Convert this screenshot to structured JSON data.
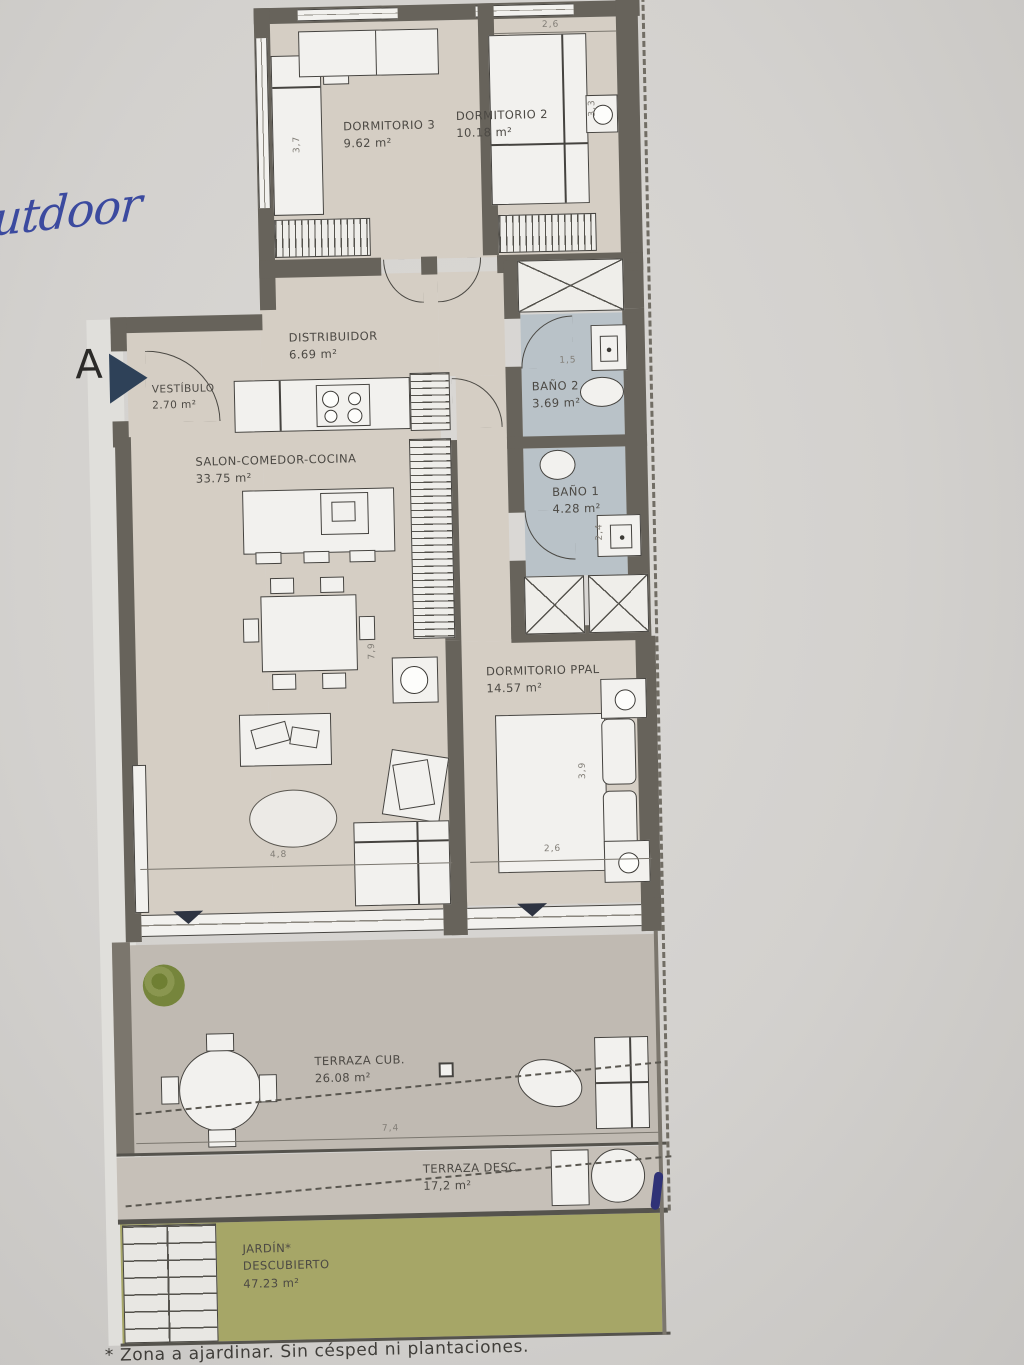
{
  "annotations": {
    "handwritten_note": "outdoor",
    "section_marker": "A",
    "footnote": "* Zona a ajardinar. Sin césped ni plantaciones."
  },
  "rooms": [
    {
      "name": "DORMITORIO 3",
      "area": "9.62 m²"
    },
    {
      "name": "DORMITORIO 2",
      "area": "10.18 m²"
    },
    {
      "name": "DISTRIBUIDOR",
      "area": "6.69 m²"
    },
    {
      "name": "VESTÍBULO",
      "area": "2.70 m²"
    },
    {
      "name": "BAÑO 2",
      "area": "3.69 m²"
    },
    {
      "name": "SALON-COMEDOR-COCINA",
      "area": "33.75 m²"
    },
    {
      "name": "BAÑO 1",
      "area": "4.28 m²"
    },
    {
      "name": "DORMITORIO PPAL",
      "area": "14.57 m²"
    },
    {
      "name": "TERRAZA CUB.",
      "area": "26.08 m²"
    },
    {
      "name": "TERRAZA DESC.",
      "area": "17,2 m²"
    },
    {
      "name": "JARDÍN*",
      "name2": "DESCUBIERTO",
      "area": "47.23 m²"
    }
  ],
  "dims": {
    "dorm2_w": "2,6",
    "dorm3_h": "3,7",
    "dorm2_h": "3,3",
    "bano2_w": "1,5",
    "bano1_h": "2,4",
    "salon_v": "7,9",
    "salon_h": "4,8",
    "ppal_v": "3,9",
    "ppal_h": "2,6",
    "terraza_w": "7,4"
  },
  "colors": {
    "wall": "#67635b",
    "floor": "#d5cec4",
    "bath_floor": "#b9c2c8",
    "terrace_floor": "#c0bab2",
    "garden": "#a6a667",
    "marker_blue": "#2e4158",
    "ink_blue": "#3b4a9f"
  }
}
